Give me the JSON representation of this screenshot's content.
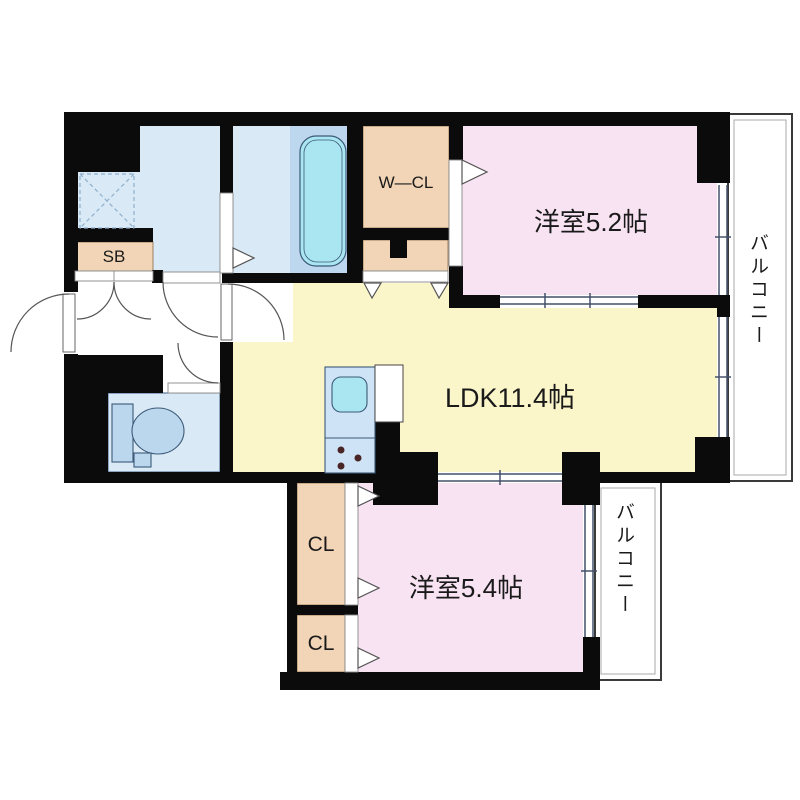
{
  "type": "apartment-floor-plan",
  "labels": {
    "room52": "洋室5.2帖",
    "ldk": "LDK11.4帖",
    "room54": "洋室5.4帖",
    "wcl": "W—CL",
    "sb": "SB",
    "cl_upper": "CL",
    "cl_lower": "CL",
    "balcony_right": "バルコニー",
    "balcony_bottom": "バルコニー"
  },
  "colors": {
    "wall": "#0b0b0b",
    "room_pink": "#f8e3f3",
    "room_yellow": "#fbf5ca",
    "closet_tan": "#f2d5b6",
    "wet_area_blue": "#d9e9f6",
    "bath_deck_blue": "#bdd7ee",
    "tub_cyan": "#a9e6f2",
    "fixture_blue": "#bad7ee",
    "kitchen_blue": "#cee3f5",
    "line_gray": "#555555"
  },
  "icons": [
    "bathtub-icon",
    "washing-machine-space-icon",
    "toilet-icon",
    "kitchen-sink-icon",
    "stove-burners-icon",
    "door-swing-arc-icon",
    "door-direction-triangle-icon",
    "sliding-window-icon"
  ]
}
